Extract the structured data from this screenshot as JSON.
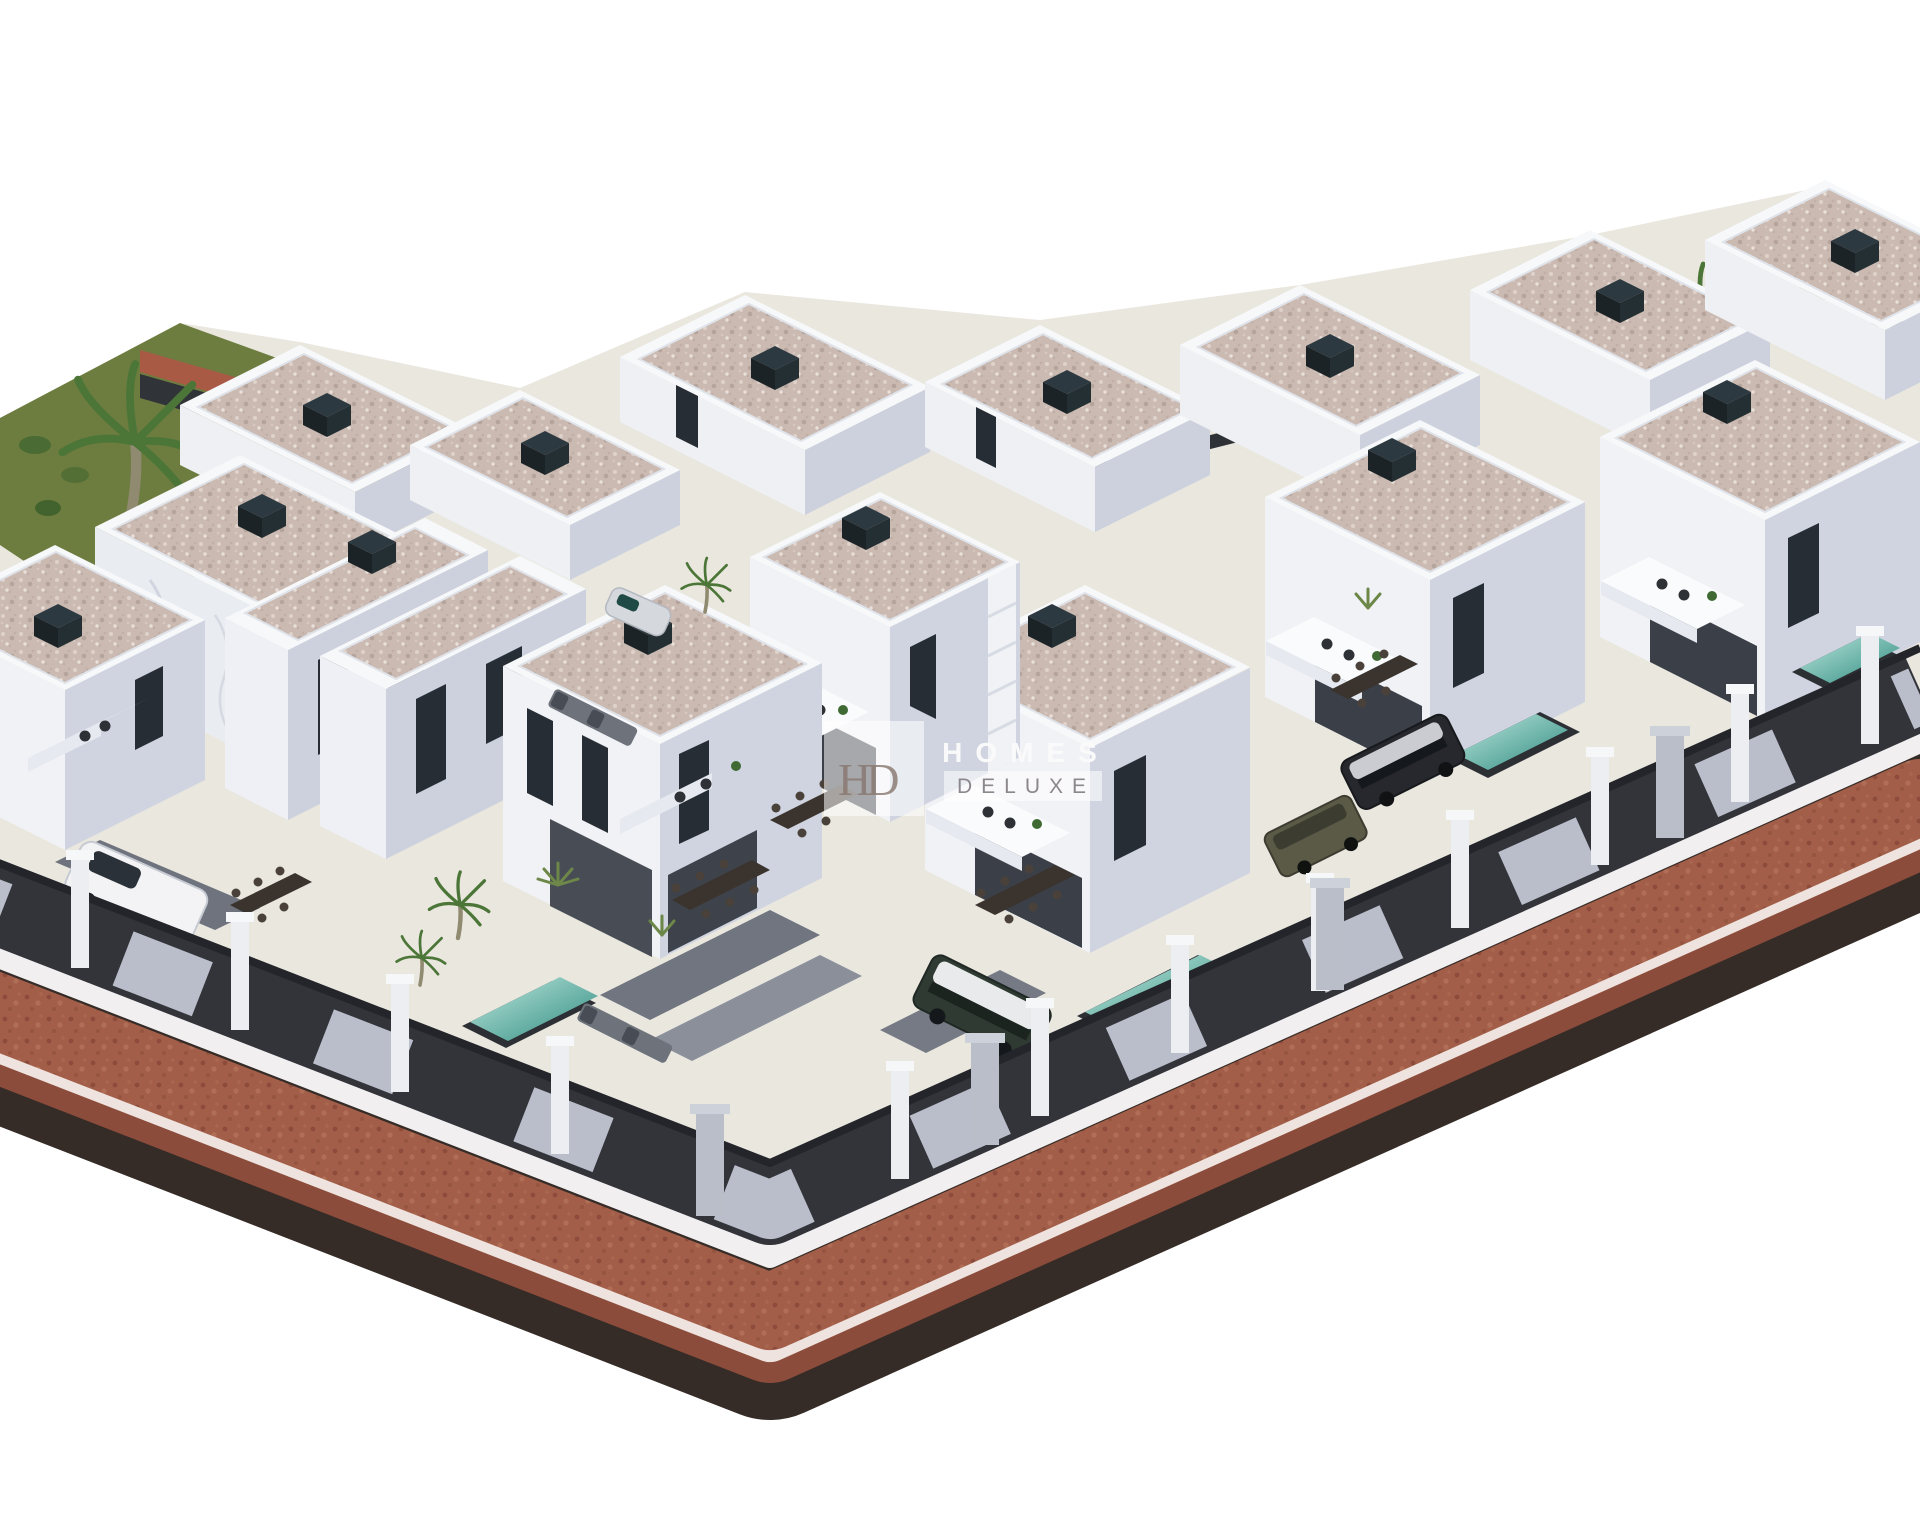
{
  "watermark": {
    "monogram": "HD",
    "brand_line1": "HOMES",
    "brand_line2": "DELUXE"
  },
  "palette": {
    "background": "#ffffff",
    "ground": "#eae7df",
    "grass": "#6d7c3f",
    "road_red": "#a25e49",
    "road_red_dark": "#8c4c3b",
    "road_edge_dark": "#362c27",
    "curb_white": "#f2eff1",
    "fence_dark": "#323439",
    "fence_panel": "#c2c6d3",
    "wall_light": "#f1f2f6",
    "wall_shade": "#cfd4e0",
    "parapet_white": "#f7f8fa",
    "roof_base": "#cbbab2",
    "window_dark": "#272d35",
    "pool_light": "#bfe8de",
    "pool_deep": "#2e8b80",
    "palm_green": "#4c7638",
    "chimney_dark": "#2c3940",
    "watermark_white": "#fbfbfb",
    "watermark_gray": "#8b878d",
    "monogram_brown": "#87766d"
  },
  "scene": {
    "type": "architectural-3d-render",
    "description": "Aerial 3D render of a corner plot residential development: white flat-roof villas with speckled terrazzo roofs, private pools, terraces with dining sets, parked cars, palm trees and a red brick sidewalk with white curbs wrapping the rounded street corner.",
    "counts": {
      "villas_visible": 13,
      "pools_visible": 3,
      "cars_visible": 5,
      "palm_trees": 7
    }
  }
}
